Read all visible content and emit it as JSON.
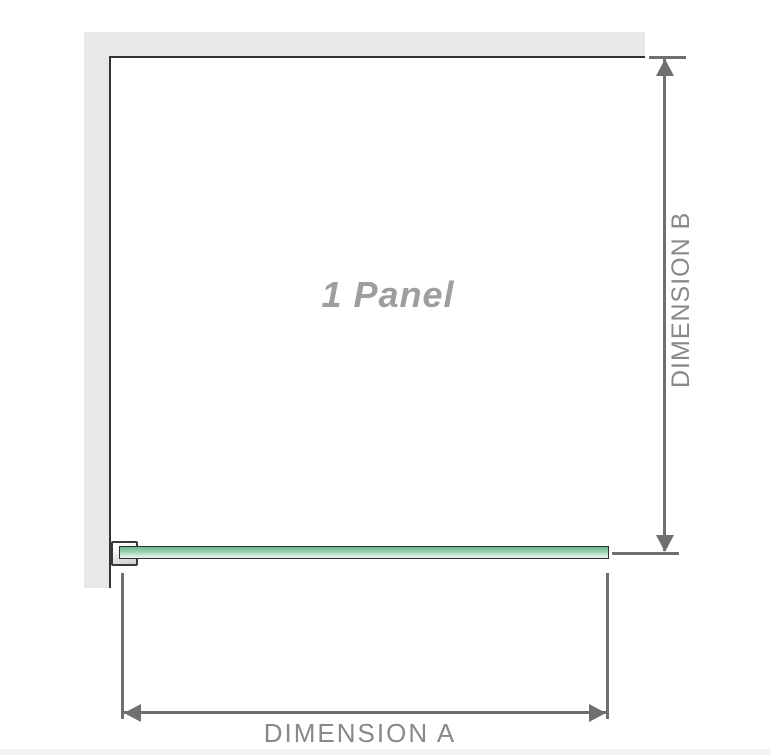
{
  "diagram": {
    "title": "1 Panel",
    "dimension_a": {
      "label": "DIMENSION A",
      "orientation": "horizontal"
    },
    "dimension_b": {
      "label": "DIMENSION B",
      "orientation": "vertical"
    }
  },
  "colors": {
    "background": "#ffffff",
    "wall_fill": "#e8e8e8",
    "frame_outline": "#333333",
    "dimension_line": "#6f6f6f",
    "dimension_text": "#87898c",
    "panel_title_text": "#9e9ea0",
    "glass_green_dark": "#72b68e",
    "glass_green_light": "#e7f5ed",
    "bracket_fill": "#ffffff",
    "bracket_outline": "#3a3a3a",
    "bottom_strip": "#f3f1f2"
  }
}
